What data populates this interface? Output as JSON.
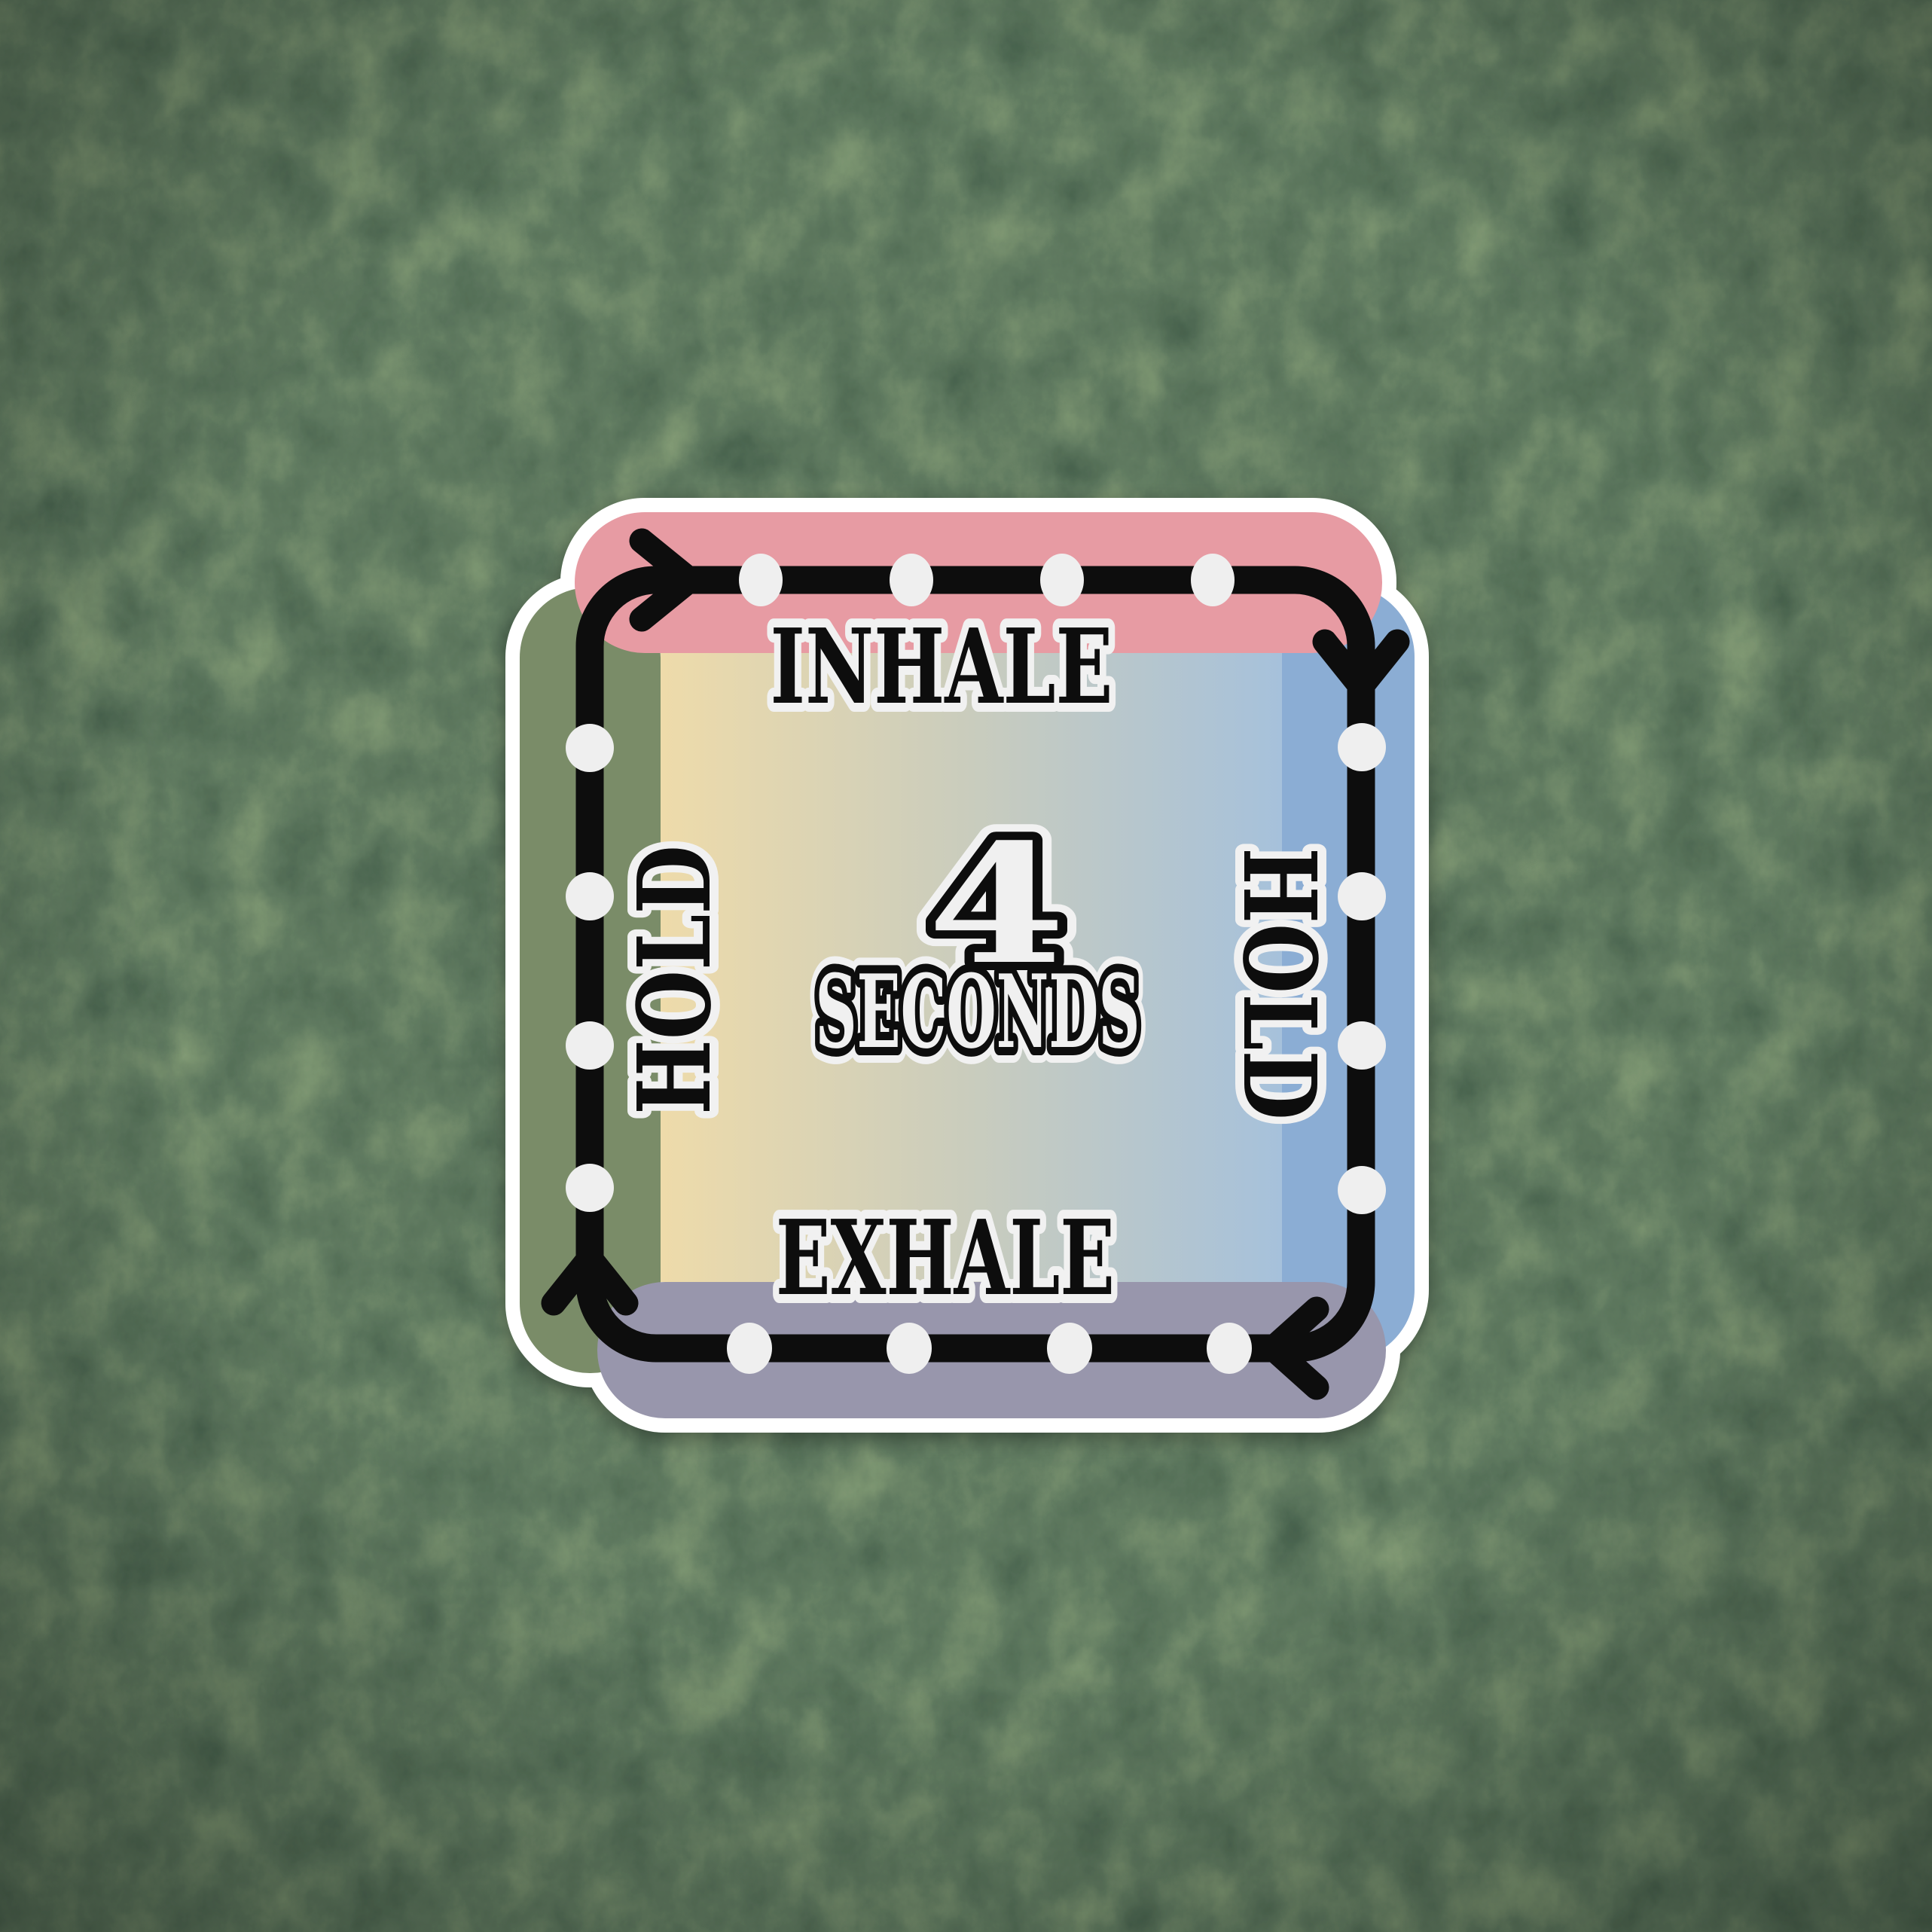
{
  "sticker": {
    "name": "box-breathing-sticker",
    "labels": {
      "top": "INHALE",
      "bottom": "EXHALE",
      "left": "HOLD",
      "right": "HOLD"
    },
    "center": {
      "value": "4",
      "unit": "SECONDS"
    },
    "icons": {
      "top_left": "arrow-right-icon",
      "top_right": "arrow-down-icon",
      "bottom_right": "arrow-left-icon",
      "bottom_left": "arrow-up-icon",
      "marker": "breath-count-dot"
    },
    "colors": {
      "pink_bar": "#e79ba3",
      "green_bar": "#7a8c68",
      "blue_bar": "#8badd4",
      "purple_bar": "#9896ac",
      "panel_left": "#eedbaa",
      "panel_mid": "#c9ccbd",
      "panel_right": "#a6c1db",
      "path_black": "#0a0a0a",
      "dot_white": "#efefef",
      "sticker_outline": "#ffffff",
      "text_outline": "#f1f1f1",
      "text_black": "#0a0a0a",
      "center_text_fill": "#f0f0f0"
    }
  }
}
